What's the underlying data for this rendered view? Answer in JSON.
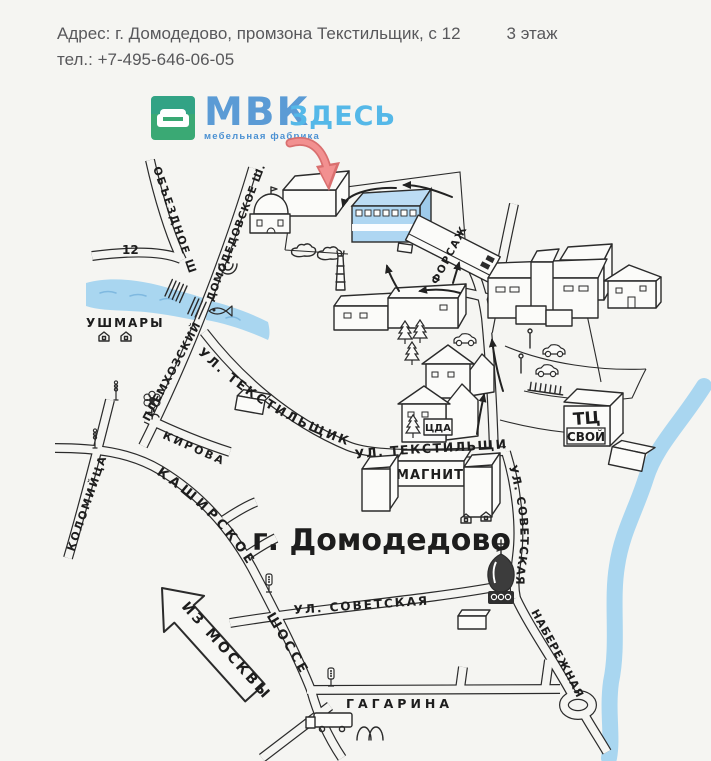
{
  "header": {
    "address": "Адрес: г. Домодедово, промзона Текстильщик, с 12",
    "floor": "3 этаж",
    "phone": "тел.: +7-495-646-06-05"
  },
  "logo": {
    "brand": "МВК",
    "tagline": "мебельная фабрика",
    "here": "ЗДЕСЬ",
    "brand_color": "#5b9bd5",
    "here_color": "#55b8e8",
    "icon_color": "#3aa974"
  },
  "map": {
    "colors": {
      "river": "#a9d6f0",
      "highlight_building": "#aed6f2",
      "red_arrow": "#ee8484",
      "ink": "#2b2b2b",
      "background": "#f5f5f2"
    },
    "labels": {
      "road_number": "12",
      "obezdnoe": "ОБЪЕЗДНОЕ  Ш",
      "domodedovskoe": "ДОМОДЕДОВСКОЕ Ш.",
      "ushmary": "УШМАРЫ",
      "plemhozskiy": "ПЛЕМХОЗСКИЙ",
      "tekstilshchikov_upper": "УЛ. ТЕКСТИЛЬЩИКОВ",
      "tekstilshchikov_lower": "УЛ. ТЕКСТИЛЬЩИКОВ",
      "kirova": "КИРОВА",
      "kolomiytsa": "КОЛОМИЙЦА",
      "kashirskoe": "КАШИРСКОЕ",
      "shosse": "ШОССЕ",
      "magnit": "МАГНИТ",
      "city": "г. Домодедово",
      "sovetskaya_h": "УЛ. СОВЕТСКАЯ",
      "sovetskaya_v": "УЛ. СОВЕТСКАЯ",
      "iz_moskvy": "ИЗ МОСКВЫ",
      "gagarina": "ГАГАРИНА",
      "naberezhnaya": "НАБЕРЕЖНАЯ",
      "forsazh": "ФОРСАЖ",
      "tc": "ТЦ",
      "svoy": "СВОЙ",
      "cda": "ЦДА"
    },
    "icons": [
      "sofa-icon",
      "red-route-arrow-icon",
      "chapel-icon",
      "horseshoe-icon",
      "fish-icon",
      "house-icon",
      "street-lamp-icon",
      "flower-icon",
      "traffic-light-icon",
      "pine-tree-icon",
      "bush-icon",
      "chimney-icon",
      "car-icon",
      "church-icon",
      "mcdonalds-arches-icon",
      "roundabout-icon",
      "bridge-icon",
      "from-moscow-arrow-icon",
      "route-arrow-icon"
    ]
  }
}
